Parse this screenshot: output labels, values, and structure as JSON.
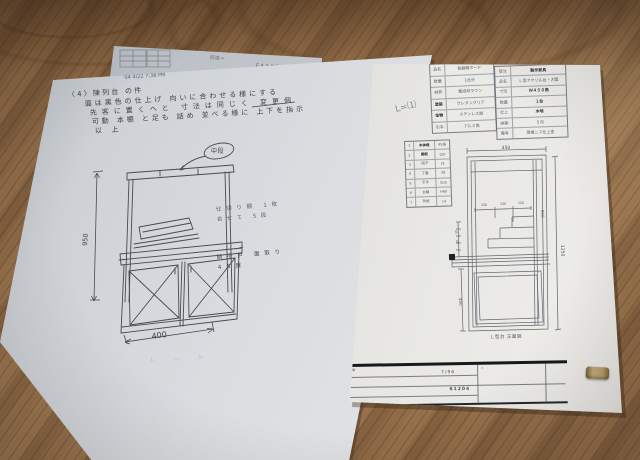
{
  "fax_sheet": {
    "route_label": "回送→",
    "fax_line": "ＦＡＸ №2447541",
    "recv_note": "受信"
  },
  "left_sheet": {
    "timestamp": "’04 4/22 7:38 PM",
    "memo": [
      "〈4〉陳列台 の件",
      "面は黒色の仕上げ 向いに合わせる様にする",
      "先客に置くヘと 寸法は同じく 変更個",
      "可動 本棚 と足も 詰め 並べる様に 上下を指示",
      "以上"
    ],
    "callout_label": "中段",
    "note_shelf_1": "仕切り棚 1枚",
    "note_shelf_2": "合せて 5段",
    "note_glass_1": "硝子戸 面取り",
    "note_glass_2": "45度",
    "dim_width": "400",
    "dim_height": "950",
    "scribble": "し ― ト"
  },
  "right_sheet": {
    "pencil_note": "L=⑴",
    "spec_table_a": {
      "rows": [
        [
          "品名",
          "食器棚ボード"
        ],
        [
          "数量",
          "1台分"
        ],
        [
          "材質",
          "集成材ラワン"
        ],
        [
          "塗装",
          "ウレタンクリア"
        ],
        [
          "金物",
          "ステンレス脚"
        ],
        [
          "引手",
          "アルミ角"
        ]
      ]
    },
    "spec_table_b": {
      "rows": [
        [
          "受注",
          "製作家具"
        ],
        [
          "品名",
          "Ｌ型アクリル台・大壁"
        ],
        [
          "寸法",
          "Ｗ４５０角"
        ],
        [
          "数量",
          "１台"
        ],
        [
          "仕上",
          "木地"
        ],
        [
          "納期",
          "５月"
        ],
        [
          "備考",
          "現場ニス仕上塗"
        ]
      ]
    },
    "materials_table": {
      "rows": [
        [
          "1",
          "本体框",
          "45角"
        ],
        [
          "2",
          "棚板",
          "t20"
        ],
        [
          "3",
          "硝子",
          "t5"
        ],
        [
          "4",
          "丁番",
          "38"
        ],
        [
          "5",
          "引手",
          "SUS"
        ],
        [
          "6",
          "台輪",
          "H60"
        ],
        [
          "7",
          "背板",
          "t4"
        ]
      ]
    },
    "drawing": {
      "dim_top": "450",
      "dim_right": "1250",
      "dim_right_mid": "950",
      "dim_left": "450",
      "small_dim_1": "150",
      "small_dim_2": "130",
      "small_dim_3": "120",
      "chain_1": "45",
      "chain_2": "45",
      "caption": "Ｌ型台 正面図"
    },
    "title_block": {
      "corner": "図",
      "scale": "7/96",
      "number": "61204",
      "dot": "・"
    }
  }
}
